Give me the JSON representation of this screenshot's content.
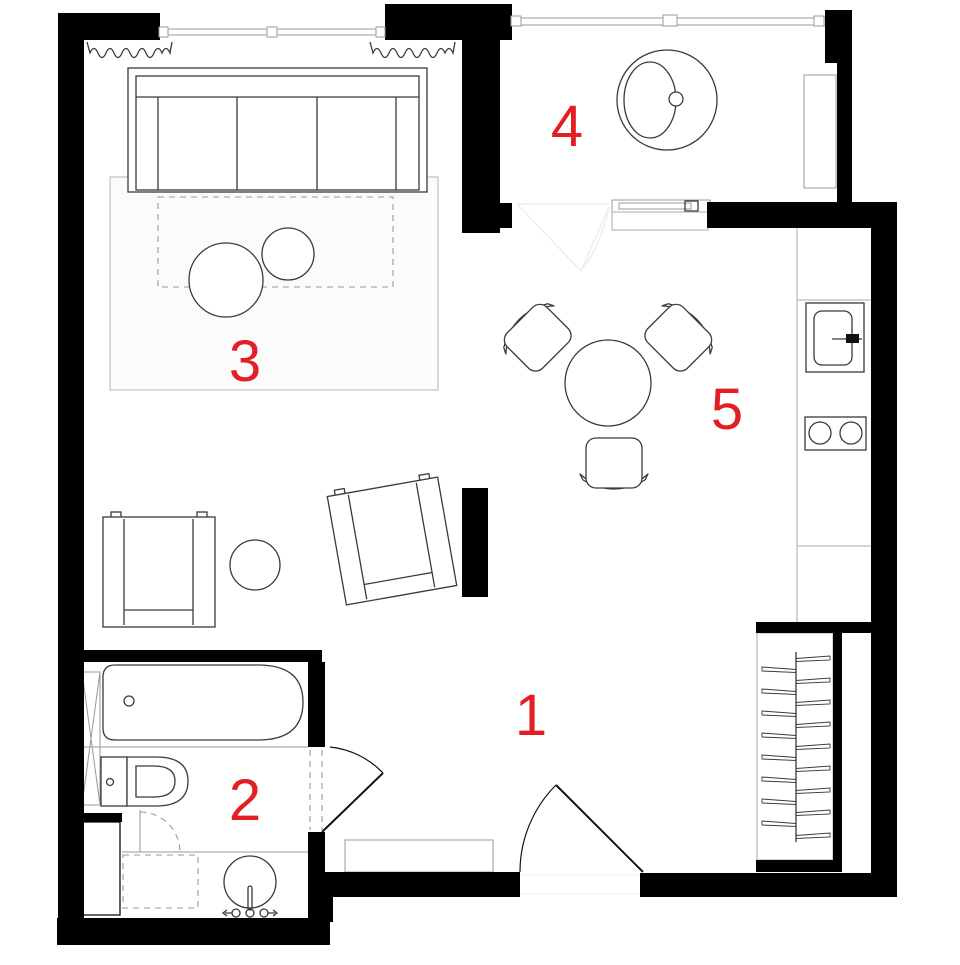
{
  "colors": {
    "wall": "#000000",
    "accent": "#e31e24",
    "line": "#3a3a3a",
    "muted": "#999999",
    "counter": "#aaaaaa"
  },
  "plan": {
    "type": "apartment-floor-plan",
    "rooms": [
      {
        "number": "1"
      },
      {
        "number": "2"
      },
      {
        "number": "3"
      },
      {
        "number": "4"
      },
      {
        "number": "5"
      }
    ],
    "icons": [
      "sofa",
      "rug",
      "coffee-table",
      "side-table",
      "armchair",
      "tv-partition",
      "dining-table",
      "dining-chair",
      "round-lounge-chair",
      "tall-cabinet",
      "kitchen-counter",
      "kitchen-sink",
      "cooktop",
      "wardrobe-rail-hangers",
      "bathtub",
      "toilet",
      "washbasin",
      "shower-tray",
      "duct-shaft",
      "appliance-niche",
      "entry-door",
      "bathroom-door",
      "interior-door",
      "sliding-door",
      "window",
      "curtain",
      "doormat"
    ]
  }
}
